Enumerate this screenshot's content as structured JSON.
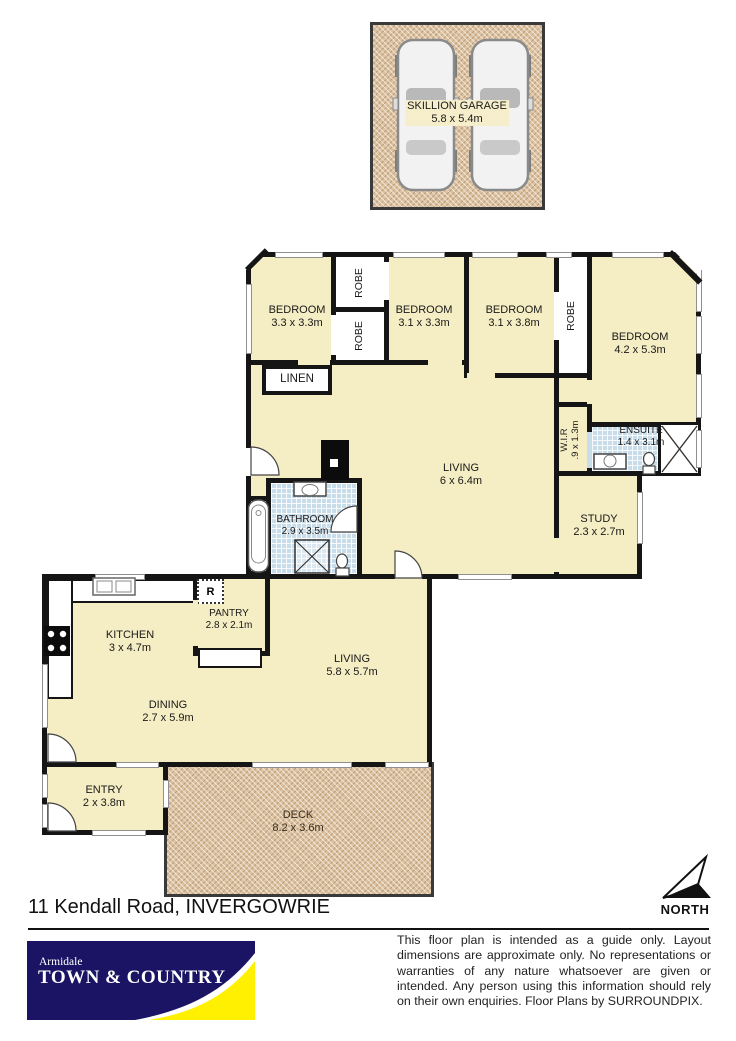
{
  "address": "11 Kendall Road, INVERGOWRIE",
  "north": "NORTH",
  "garage": {
    "name": "SKILLION GARAGE",
    "dims": "5.8 x 5.4m"
  },
  "rooms": {
    "bedroom1": {
      "name": "BEDROOM",
      "dims": "3.3 x 3.3m"
    },
    "bedroom2": {
      "name": "BEDROOM",
      "dims": "3.1 x 3.3m"
    },
    "bedroom3": {
      "name": "BEDROOM",
      "dims": "3.1 x 3.8m"
    },
    "bedroom4": {
      "name": "BEDROOM",
      "dims": "4.2 x 5.3m"
    },
    "robe_top": {
      "name": "ROBE"
    },
    "robe_bottom": {
      "name": "ROBE"
    },
    "robe_right": {
      "name": "ROBE"
    },
    "linen": {
      "name": "LINEN"
    },
    "living_upper": {
      "name": "LIVING",
      "dims": "6 x 6.4m"
    },
    "wir": {
      "name": "W.I.R",
      "dims": ".9 x 1.3m"
    },
    "ensuite": {
      "name": "ENSUITE",
      "dims": "1.4 x 3.1m"
    },
    "study": {
      "name": "STUDY",
      "dims": "2.3 x 2.7m"
    },
    "bathroom": {
      "name": "BATHROOM",
      "dims": "2.9 x 3.5m"
    },
    "pantry": {
      "name": "PANTRY",
      "dims": "2.8 x 2.1m"
    },
    "fridge": {
      "label": "R"
    },
    "kitchen": {
      "name": "KITCHEN",
      "dims": "3 x 4.7m"
    },
    "dining": {
      "name": "DINING",
      "dims": "2.7 x 5.9m"
    },
    "living_lower": {
      "name": "LIVING",
      "dims": "5.8 x 5.7m"
    },
    "entry": {
      "name": "ENTRY",
      "dims": "2 x 3.8m"
    },
    "deck": {
      "name": "DECK",
      "dims": "8.2 x 3.6m"
    }
  },
  "logo": {
    "top": "Armidale",
    "main": "TOWN & COUNTRY"
  },
  "disclaimer": "This floor plan is intended as a guide only. Layout dimensions are approximate only. No representations or warranties of any nature whatsoever are given or intended. Any person using this information should rely on their own enquiries. Floor Plans by  SURROUNDPIX.",
  "colors": {
    "wall": "#151515",
    "room_fill": "#f5edc3",
    "deck_fill": "#dcc2a0",
    "tile_fill": "#c9dcea",
    "logo_navy": "#1b1464",
    "logo_yellow": "#ffef00"
  }
}
